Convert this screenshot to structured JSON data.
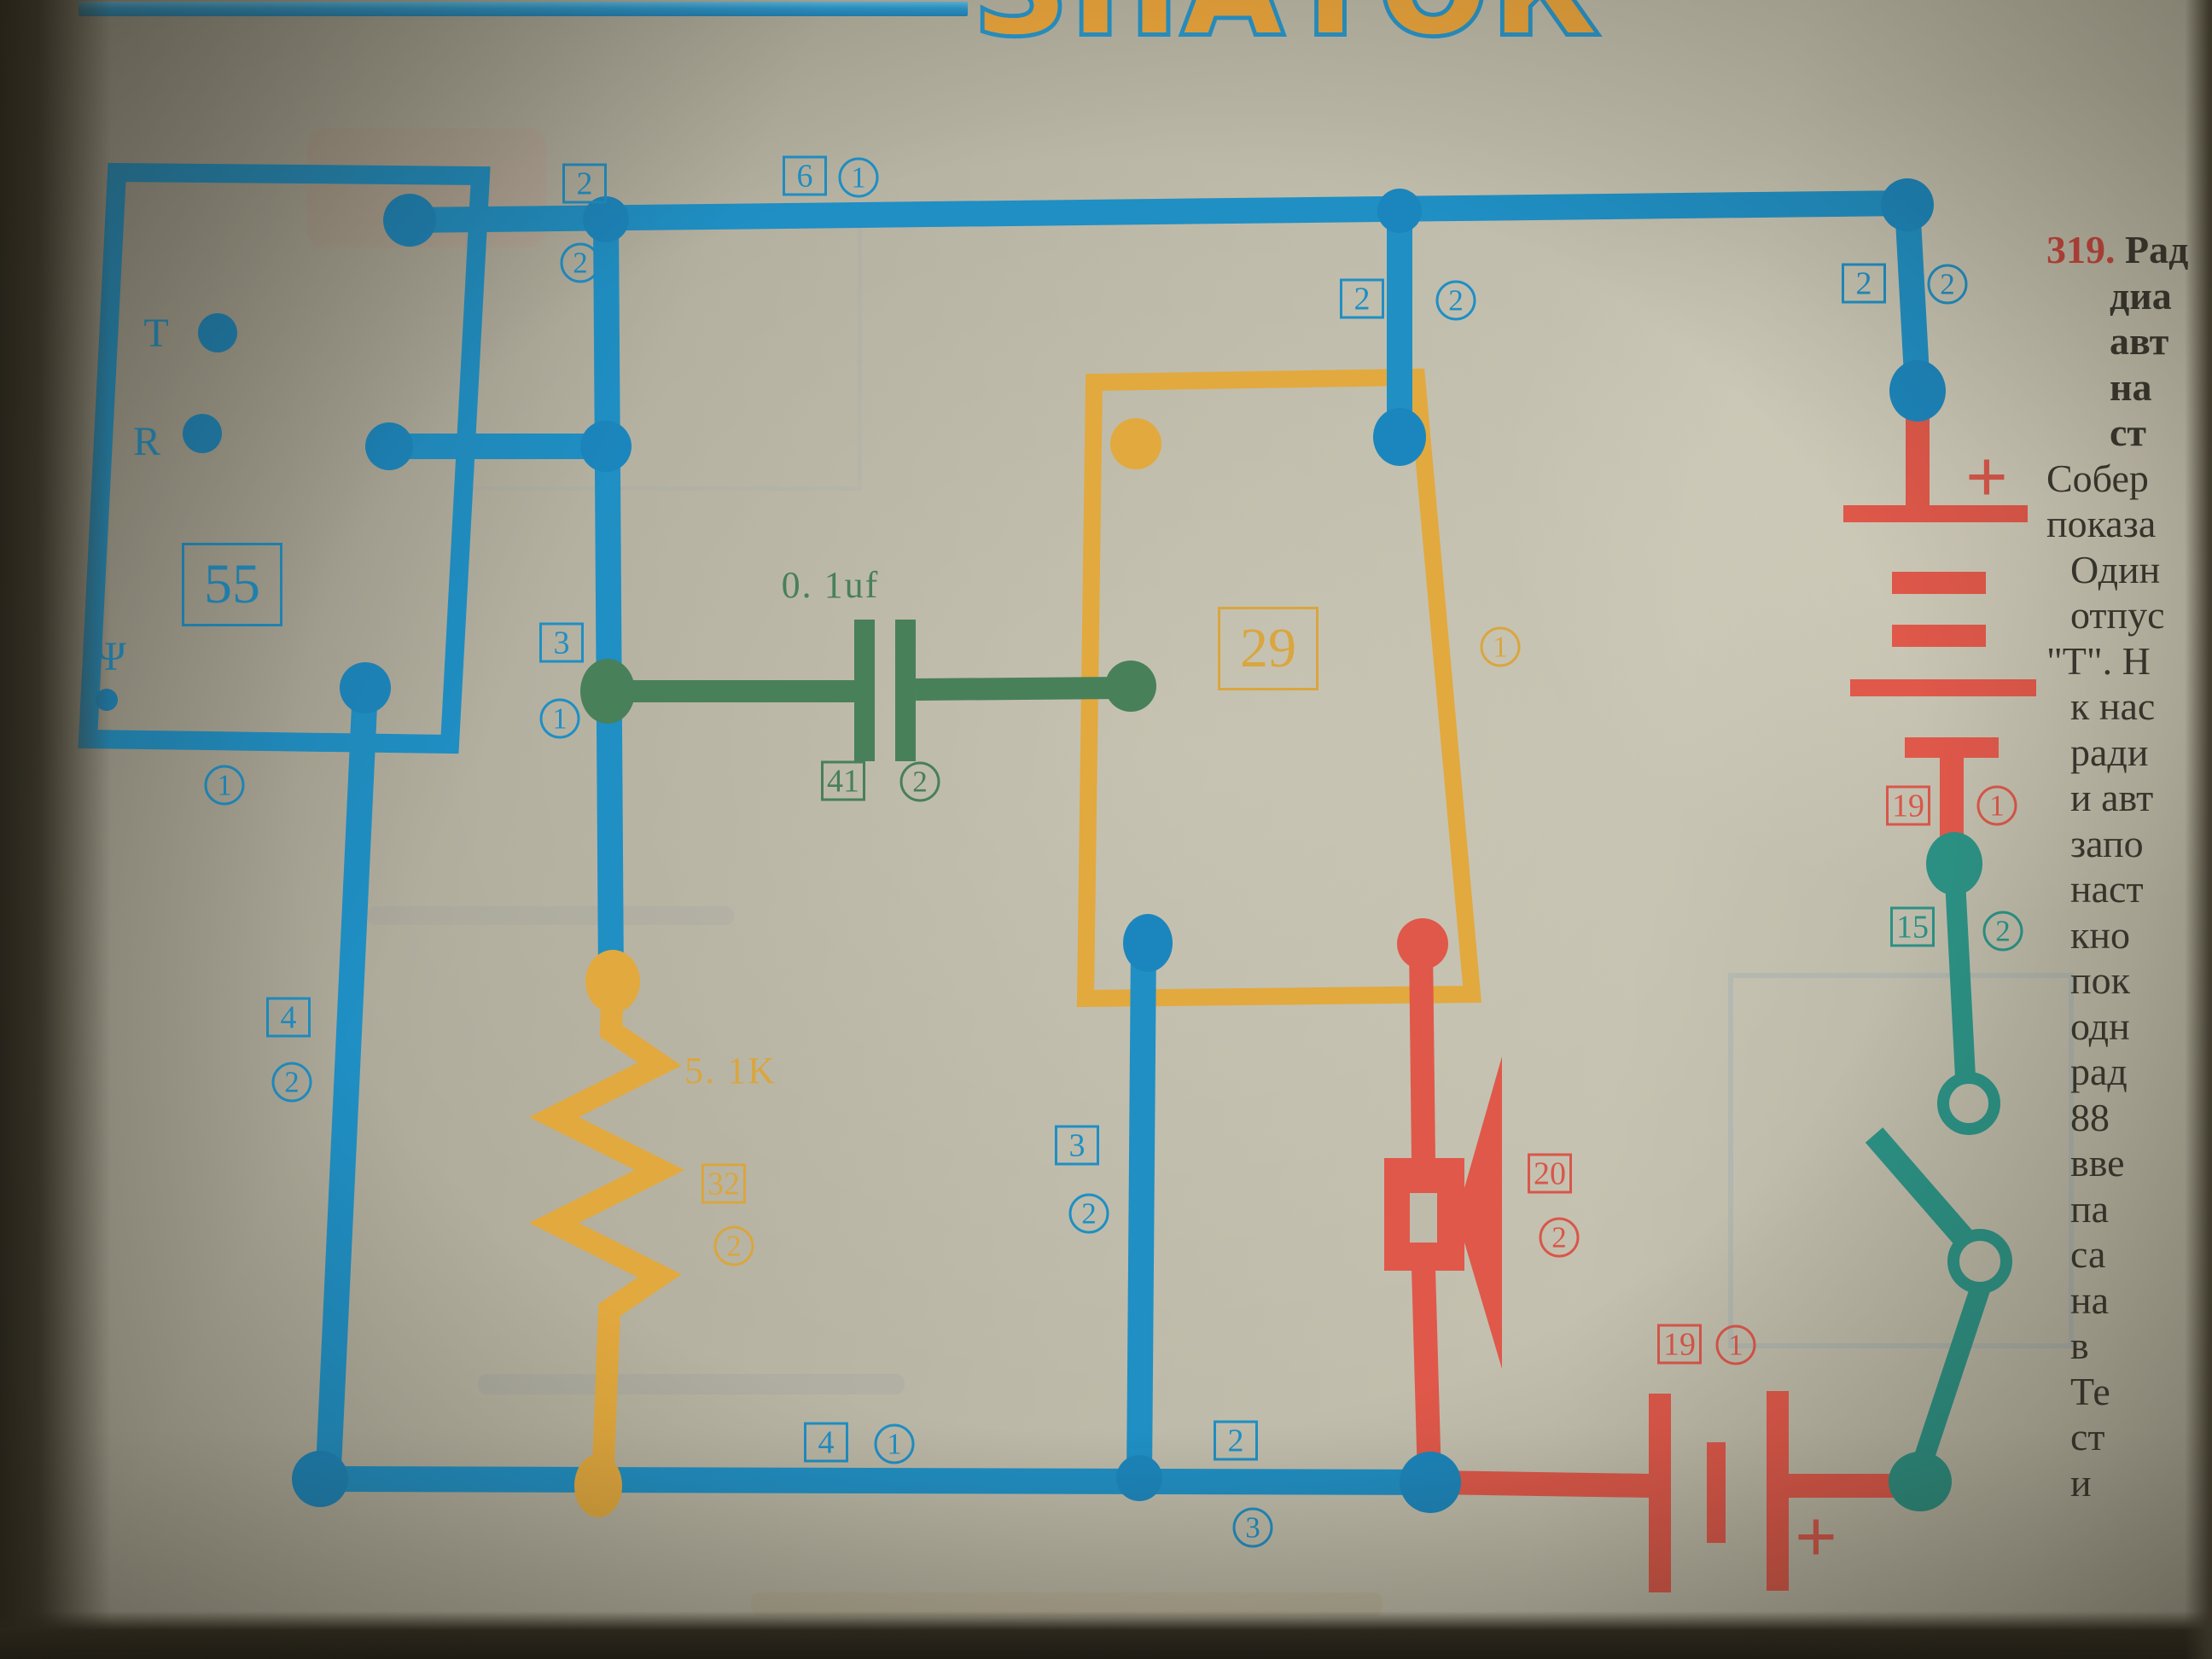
{
  "page": {
    "logo": "ЗНАТОК"
  },
  "article": {
    "number": "319.",
    "title_lines": [
      "Рад",
      "диа",
      "авт",
      "на",
      "ст"
    ],
    "body_lines": [
      "Собер",
      "показа",
      "Один",
      "отпус",
      "\"Т\". Н",
      "к нас",
      "ради",
      "и авт",
      "запо",
      "наст",
      "кно",
      "пок",
      "одн",
      "рад",
      "88",
      "вве",
      "па",
      "са",
      "на",
      "в",
      "Те",
      "ст",
      "и"
    ]
  },
  "labels": [
    {
      "text": "2"
    },
    {
      "text": "2"
    },
    {
      "text": "6"
    },
    {
      "text": "1"
    },
    {
      "text": "2"
    },
    {
      "text": "2"
    },
    {
      "text": "2"
    },
    {
      "text": "2"
    },
    {
      "text": "3"
    },
    {
      "text": "1"
    },
    {
      "text": "3"
    },
    {
      "text": "2"
    },
    {
      "text": "4"
    },
    {
      "text": "2"
    },
    {
      "text": "4"
    },
    {
      "text": "1"
    },
    {
      "text": "2"
    },
    {
      "text": "3"
    },
    {
      "text": "1"
    },
    {
      "text": "T"
    },
    {
      "text": "R"
    },
    {
      "text": "Ψ"
    },
    {
      "text": "55"
    },
    {
      "text": "0. 1uf"
    },
    {
      "text": "41"
    },
    {
      "text": "2"
    },
    {
      "text": "29"
    },
    {
      "text": "1"
    },
    {
      "text": "5. 1K"
    },
    {
      "text": "32"
    },
    {
      "text": "2"
    },
    {
      "text": "20"
    },
    {
      "text": "2"
    },
    {
      "text": "19"
    },
    {
      "text": "1"
    },
    {
      "text": "19"
    },
    {
      "text": "1"
    },
    {
      "text": "+"
    },
    {
      "text": "+"
    },
    {
      "text": "15"
    },
    {
      "text": "2"
    }
  ]
}
